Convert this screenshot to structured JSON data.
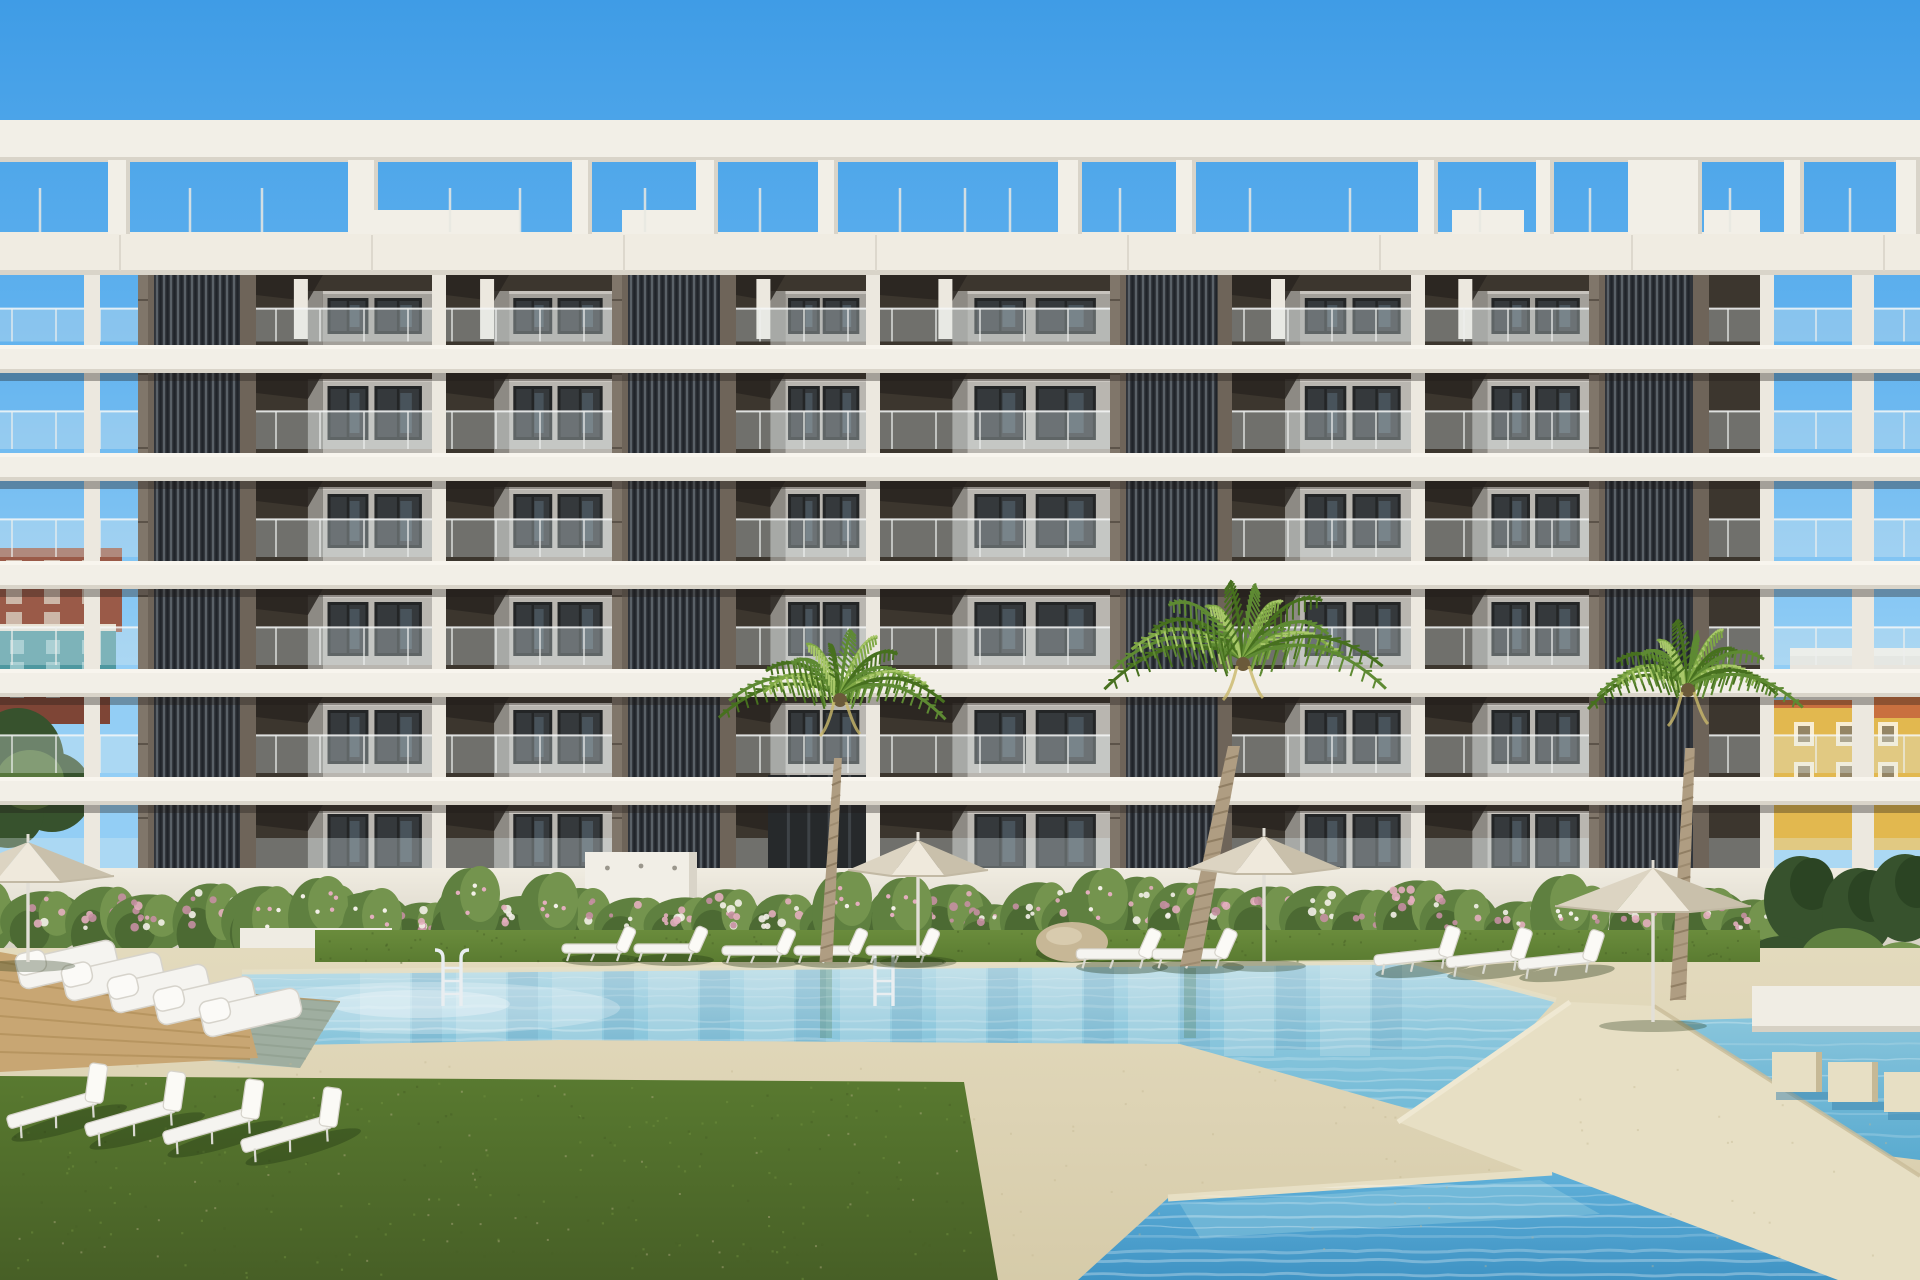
{
  "scene": {
    "description": "3D architectural render of a modern white apartment building with rooftop pergola, dark slatted cores, balconies, flowering hedge wall, palm trees, sun loungers, parasols and turquoise swimming pools",
    "visible_text": "none"
  },
  "palette": {
    "sky_top": "#3f9ce6",
    "sky_mid": "#5fb1ee",
    "sky_low": "#93cef5",
    "slab": "#f2efe7",
    "slab_shade": "#d9d4c9",
    "fascia": "#f0ece2",
    "ceiling_dark": "#292420",
    "ceiling_mid": "#3c362e",
    "module_front": "#b9b6b0",
    "module_side": "#8d8a84",
    "module_dark": "#77746e",
    "window_glass": "#35393c",
    "window_frame": "#232526",
    "glass_hi": "#6e8495",
    "core_base": "#30343a",
    "core_slat": "#5a6168",
    "core_gap": "#20242a",
    "pilaster": "#6e6459",
    "pilaster_hi": "#80766a",
    "mullion": "#ece8df",
    "rail_glass": "rgba(225,235,240,0.32)",
    "rail_post": "#eef0ee",
    "wall": "#ebe7dc",
    "wall_shade": "#d8d3c6",
    "hedge_dark": "#4c6a33",
    "hedge_mid": "#5f8040",
    "hedge_light": "#74944e",
    "flower_pink": "#e3aebe",
    "flower_white": "#f3f0e8",
    "flower_deep": "#c58fa2",
    "tree_dark": "#37522d",
    "tree_deep": "#2b4423",
    "grass_light": "#6a8c3c",
    "grass_mid": "#597a30",
    "grass_dark": "#475f26",
    "sand": "#ddd3b4",
    "sand_light": "#e7dfc4",
    "sand_shade": "#c6b996",
    "pool_far": "#bfdfe9",
    "pool_mid": "#8ac6dc",
    "pool_near": "#6db8d6",
    "pool_deep": "#5aabd0",
    "pool2_top": "#62b2da",
    "pool2_deep": "#3f93c4",
    "wood": "#c8a673",
    "wood_dark": "#b08f58",
    "trunk": "#af9d82",
    "trunk_dark": "#8d7b60",
    "palm_dark": "#47701f",
    "palm_mid": "#5e8a33",
    "palm_light": "#7fa845",
    "palm_hi": "#a9c86a",
    "umbrella": "#efe9dc",
    "umbrella_shade": "#dcd4c2",
    "umbrella_dark": "#c9c0ab",
    "pole": "#e2dfd7",
    "lounger": "#f5f4f0",
    "lounger_shade": "#d6d3cb",
    "boulder": "#c7b796",
    "boulder_shade": "#a6936f",
    "chrome": "#e9eef1",
    "bg_red": "#9a5a48",
    "bg_red_dark": "#7e4536",
    "bg_teal": "#4e98a0",
    "bg_trim": "#a5503f",
    "bg_white": "#e8e5de",
    "bg_yellow": "#e2b84f",
    "bg_yellow_dark": "#c9992f",
    "bg_roof": "#c9703f"
  },
  "layout": {
    "width": 1920,
    "height": 1280,
    "pergola": {
      "rail": [
        120,
        162
      ],
      "fascia": [
        232,
        275
      ],
      "piers": [
        [
          108,
          22
        ],
        [
          348,
          30
        ],
        [
          572,
          20
        ],
        [
          696,
          22
        ],
        [
          818,
          20
        ],
        [
          1058,
          24
        ],
        [
          1176,
          20
        ],
        [
          1418,
          20
        ],
        [
          1536,
          18
        ],
        [
          1628,
          74
        ],
        [
          1784,
          20
        ],
        [
          1896,
          24
        ]
      ],
      "spikes": [
        40,
        190,
        262,
        450,
        520,
        645,
        760,
        900,
        965,
        1010,
        1120,
        1250,
        1350,
        1480,
        1590,
        1730,
        1850
      ],
      "sills": [
        [
          352,
          520
        ],
        [
          622,
          710
        ],
        [
          1452,
          1524
        ],
        [
          1704,
          1760
        ]
      ]
    },
    "floors": [
      [
        275,
        345
      ],
      [
        373,
        453
      ],
      [
        481,
        561
      ],
      [
        589,
        669
      ],
      [
        697,
        777
      ],
      [
        805,
        868
      ]
    ],
    "slabs": [
      [
        345,
        28
      ],
      [
        453,
        28
      ],
      [
        561,
        28
      ],
      [
        669,
        28
      ],
      [
        777,
        28
      ]
    ],
    "facade": [
      138,
      1774
    ],
    "cores": [
      [
        138,
        118
      ],
      [
        612,
        124
      ],
      [
        1110,
        122
      ],
      [
        1589,
        120
      ]
    ],
    "mullions": [
      [
        432,
        14
      ],
      [
        866,
        14
      ],
      [
        1411,
        14
      ],
      [
        1760,
        14
      ]
    ],
    "bays": [
      [
        256,
        432
      ],
      [
        446,
        612
      ],
      [
        736,
        866
      ],
      [
        880,
        1110
      ],
      [
        1232,
        1411
      ],
      [
        1425,
        1589
      ],
      [
        1709,
        1760
      ]
    ],
    "corner_posts": [
      [
        84,
        16
      ],
      [
        1852,
        22
      ]
    ],
    "wall_y": 868,
    "grass_strip": [
      315,
      930,
      1445,
      32
    ],
    "entrance": [
      768,
      775,
      102,
      100
    ],
    "monolith": [
      585,
      852,
      112,
      94
    ]
  },
  "pools": {
    "main": [
      [
        242,
        972
      ],
      [
        1412,
        962
      ],
      [
        1556,
        1000
      ],
      [
        1448,
        1120
      ],
      [
        1180,
        1044
      ],
      [
        560,
        1040
      ],
      [
        238,
        1046
      ]
    ],
    "right_strip": [
      [
        1612,
        1022
      ],
      [
        1920,
        1014
      ],
      [
        1920,
        1160
      ],
      [
        1676,
        1130
      ]
    ],
    "walkway": [
      [
        1398,
        1122
      ],
      [
        1570,
        1002
      ],
      [
        1654,
        1006
      ],
      [
        1920,
        1176
      ],
      [
        1920,
        1280
      ],
      [
        1806,
        1280
      ]
    ],
    "secondary": [
      [
        1168,
        1198
      ],
      [
        1552,
        1172
      ],
      [
        1838,
        1280
      ],
      [
        1078,
        1280
      ]
    ],
    "wood_steps": [
      [
        52,
        978
      ],
      [
        340,
        1002
      ],
      [
        300,
        1068
      ],
      [
        30,
        1042
      ]
    ],
    "ladders": [
      452,
      884
    ],
    "blocks": [
      [
        1772,
        1052
      ],
      [
        1828,
        1062
      ],
      [
        1884,
        1072
      ]
    ],
    "planter": [
      1752,
      986,
      168,
      46
    ],
    "lawn": [
      [
        0,
        1076
      ],
      [
        964,
        1082
      ],
      [
        998,
        1280
      ],
      [
        0,
        1280
      ]
    ]
  },
  "flora": {
    "palms": [
      {
        "crown": [
          840,
          696
        ],
        "r": 118,
        "trunk": [
          [
            826,
            962
          ],
          [
            838,
            758
          ]
        ],
        "w": 13
      },
      {
        "crown": [
          1243,
          660
        ],
        "r": 150,
        "trunk": [
          [
            1190,
            966
          ],
          [
            1234,
            746
          ]
        ],
        "w": 20
      },
      {
        "crown": [
          1688,
          686
        ],
        "r": 115,
        "trunk": [
          [
            1678,
            1000
          ],
          [
            1690,
            748
          ]
        ],
        "w": 16
      }
    ],
    "hedge": {
      "x1": -20,
      "x2": 1790,
      "base": 944,
      "step": 50
    },
    "accent_bushes": [
      [
        262,
        898
      ],
      [
        318,
        884
      ],
      [
        372,
        896
      ],
      [
        470,
        874
      ],
      [
        548,
        880
      ],
      [
        842,
        878
      ],
      [
        902,
        884
      ],
      [
        1098,
        876
      ],
      [
        1560,
        882
      ]
    ],
    "right_trees": [
      [
        1800,
        900
      ],
      [
        1858,
        912
      ],
      [
        1905,
        898
      ]
    ],
    "planter_bushes": [
      240,
      928,
      152,
      40
    ]
  },
  "furniture": {
    "umbrellas": [
      {
        "x": 28,
        "y": 872,
        "r": 86,
        "h": 30,
        "pole": 90
      },
      {
        "x": 918,
        "y": 866,
        "r": 70,
        "h": 26,
        "pole": 92
      },
      {
        "x": 1264,
        "y": 864,
        "r": 76,
        "h": 28,
        "pole": 98
      },
      {
        "x": 1653,
        "y": 902,
        "r": 98,
        "h": 34,
        "pole": 120
      }
    ],
    "strip_loungers": [
      [
        600,
        952,
        1,
        0
      ],
      [
        672,
        952,
        1,
        0
      ],
      [
        760,
        954,
        1,
        0
      ],
      [
        832,
        954,
        1,
        0
      ],
      [
        904,
        954,
        1,
        0
      ],
      [
        1120,
        958,
        1.15,
        0
      ],
      [
        1196,
        958,
        1.15,
        0
      ],
      [
        1420,
        960,
        1.2,
        -6
      ],
      [
        1492,
        962,
        1.2,
        -6
      ],
      [
        1564,
        964,
        1.2,
        -6
      ]
    ],
    "lawn_loungers": [
      [
        64,
        1112,
        1.5,
        -16
      ],
      [
        142,
        1120,
        1.5,
        -16
      ],
      [
        220,
        1128,
        1.5,
        -16
      ],
      [
        298,
        1136,
        1.5,
        -16
      ]
    ],
    "daybeds": [
      [
        30,
        972
      ],
      [
        76,
        984
      ],
      [
        122,
        996
      ],
      [
        168,
        1008
      ],
      [
        214,
        1020
      ]
    ],
    "boulder": [
      1072,
      942,
      36,
      20
    ]
  },
  "background": {
    "left": [
      {
        "rect": [
          0,
          548,
          122,
          84
        ],
        "fill": "bg_red"
      },
      {
        "rect": [
          0,
          628,
          116,
          68
        ],
        "fill": "bg_teal"
      },
      {
        "rect": [
          0,
          694,
          110,
          30
        ],
        "fill": "bg_red_dark"
      }
    ],
    "left_foliage": [
      [
        18,
        760,
        46,
        52
      ],
      [
        52,
        792,
        40,
        40
      ],
      [
        8,
        812,
        36,
        36
      ]
    ],
    "right": [
      {
        "rect": [
          1790,
          652,
          130,
          62
        ],
        "fill": "bg_white"
      },
      {
        "rect": [
          1774,
          702,
          146,
          148
        ],
        "fill": "bg_yellow"
      },
      {
        "rect": [
          1856,
          688,
          64,
          30
        ],
        "fill": "bg_roof"
      }
    ]
  }
}
